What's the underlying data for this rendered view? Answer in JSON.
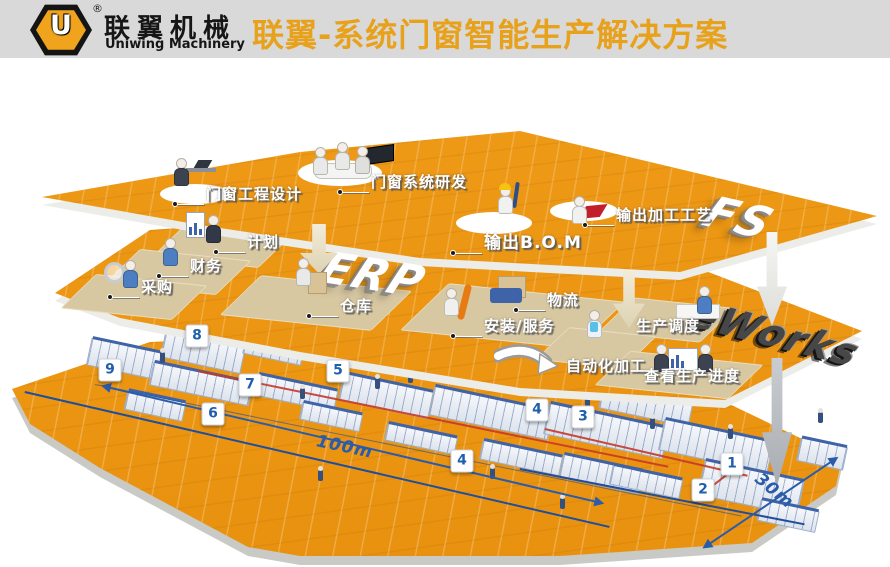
{
  "header": {
    "logo": {
      "monogram": "U",
      "reg_mark": "®",
      "brand_cn": "联翼机械",
      "brand_en": "Uniwing Machinery"
    },
    "title": "联翼-系统门窗智能生产解决方案"
  },
  "colors": {
    "header_bg": "#D9D9D9",
    "title_orange": "#E8A11B",
    "platform_orange": "#EE9712",
    "logo_orange": "#F0A31C",
    "marker_blue": "#1F5FAE",
    "dimension_blue": "#2A5CAA",
    "route_red": "#C5392B",
    "label_white": "#FFFFFF"
  },
  "layers": {
    "top": {
      "name_3d": "FS",
      "labels": [
        {
          "text": "门窗工程设计"
        },
        {
          "text": "门窗系统研发"
        },
        {
          "text": "输出B.O.M"
        },
        {
          "text": "输出加工工艺"
        }
      ]
    },
    "middle": {
      "erp_3d": "ERP",
      "eworks_3d": "eWorks",
      "labels": [
        {
          "text": "计划"
        },
        {
          "text": "财务"
        },
        {
          "text": "采购"
        },
        {
          "text": "仓库"
        },
        {
          "text": "物流"
        },
        {
          "text": "安装/服务"
        },
        {
          "text": "生产调度"
        },
        {
          "text": "自动化加工"
        },
        {
          "text": "查看生产进度"
        }
      ]
    },
    "floor": {
      "markers": [
        {
          "text": "9"
        },
        {
          "text": "8"
        },
        {
          "text": "7"
        },
        {
          "text": "6"
        },
        {
          "text": "5"
        },
        {
          "text": "4"
        },
        {
          "text": "4"
        },
        {
          "text": "3"
        },
        {
          "text": "2"
        },
        {
          "text": "1"
        }
      ],
      "dimensions": [
        {
          "text": "100m"
        },
        {
          "text": "30m"
        }
      ]
    }
  }
}
